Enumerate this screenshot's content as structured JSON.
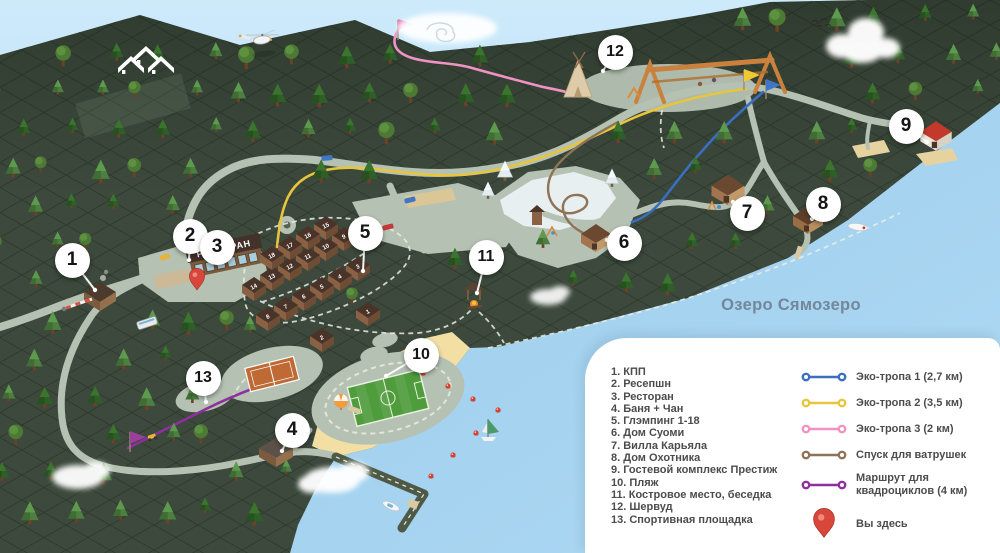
{
  "map": {
    "lake_label": "Озеро Сямозеро",
    "restaurant_sign": "РЕСТОРАН",
    "markers": [
      "1",
      "2",
      "3",
      "4",
      "5",
      "6",
      "7",
      "8",
      "9",
      "10",
      "11",
      "12",
      "13"
    ],
    "glamping_cabin_numbers": [
      "1",
      "2",
      "3",
      "4",
      "5",
      "6",
      "7",
      "8",
      "9",
      "10",
      "11",
      "12",
      "13",
      "14",
      "15",
      "16",
      "17",
      "18"
    ]
  },
  "legend": {
    "locations": [
      "1. КПП",
      "2. Ресепшн",
      "3. Ресторан",
      "4. Баня + Чан",
      "5. Глэмпинг 1-18",
      "6. Дом Суоми",
      "7. Вилла Карьяла",
      "8. Дом Охотника",
      "9. Гостевой комплекс Престиж",
      "10. Пляж",
      "11. Костровое место, беседка",
      "12. Шервуд",
      "13. Спортивная площадка"
    ],
    "routes": [
      {
        "name": "eco-trail-1",
        "label": "Эко-тропа 1 (2,7 км)",
        "color": "#3a6fc0"
      },
      {
        "name": "eco-trail-2",
        "label": "Эко-тропа 2 (3,5 км)",
        "color": "#e7c53d"
      },
      {
        "name": "eco-trail-3",
        "label": "Эко-тропа 3 (2 км)",
        "color": "#f093c4"
      },
      {
        "name": "tubing-slope",
        "label": "Спуск для ватрушек",
        "color": "#8f7356"
      },
      {
        "name": "quad-route",
        "label": "Маршрут для квадроциклов (4 км)",
        "color": "#8e2f9e"
      }
    ],
    "you_are_here": "Вы здесь",
    "pin_color": "#d8473a"
  }
}
